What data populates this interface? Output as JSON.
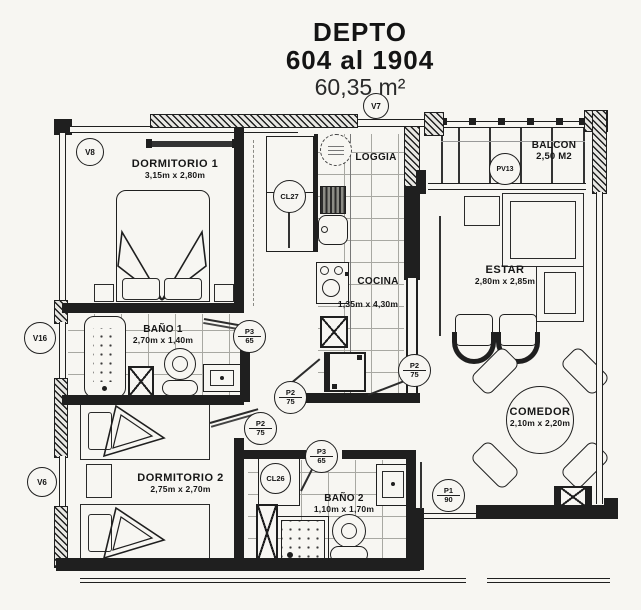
{
  "colors": {
    "ink": "#1f1f1f",
    "paper": "#f7f6f2",
    "grid": "#a8a8a2"
  },
  "title": {
    "line1": "DEPTO",
    "line2": "604 al 1904",
    "line3": "60,35 m²"
  },
  "rooms": {
    "dormitorio1": {
      "name": "DORMITORIO 1",
      "dims": "3,15m x 2,80m"
    },
    "loggia": {
      "name": "LOGGIA"
    },
    "balcon": {
      "name": "BALCON",
      "dims": "2,50 M2"
    },
    "cocina": {
      "name": "COCINA",
      "dims": "1,35m x 4,30m"
    },
    "estar": {
      "name": "ESTAR",
      "dims": "2,80m x 2,85m"
    },
    "bano1": {
      "name": "BAÑO 1",
      "dims": "2,70m x 1,40m"
    },
    "comedor": {
      "name": "COMEDOR",
      "dims": "2,10m x 2,20m"
    },
    "dormitorio2": {
      "name": "DORMITORIO 2",
      "dims": "2,75m x 2,70m"
    },
    "bano2": {
      "name": "BAÑO 2",
      "dims": "1,10m x 1,70m"
    }
  },
  "markers": {
    "v8": "V8",
    "v7": "V7",
    "pv13": "PV13",
    "v16": "V16",
    "v6": "V6",
    "cl27": "CL27",
    "cl26": "CL26",
    "p3_bano1": {
      "top": "P3",
      "bottom": "65"
    },
    "p3_bano2": {
      "top": "P3",
      "bottom": "65"
    },
    "p2_cocina": {
      "top": "P2",
      "bottom": "75"
    },
    "p2_dorm2": {
      "top": "P2",
      "bottom": "75"
    },
    "p2_estar": {
      "top": "P2",
      "bottom": "75"
    },
    "p1_acceso": {
      "top": "P1",
      "bottom": "90"
    }
  }
}
